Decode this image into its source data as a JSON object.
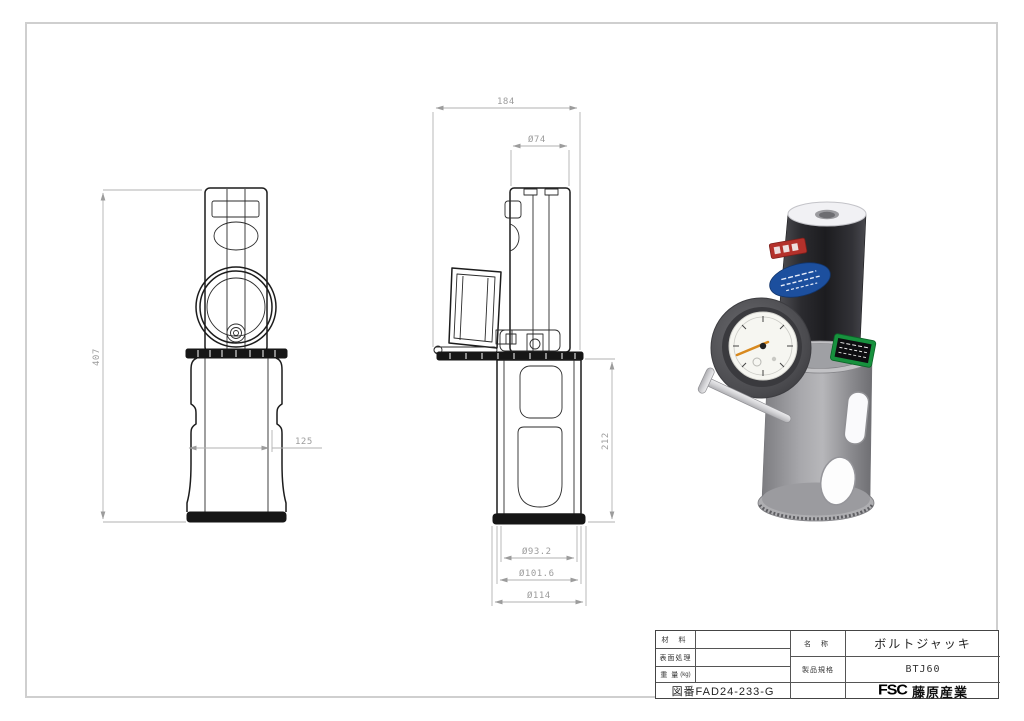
{
  "dimensions": {
    "front_height": "407",
    "front_base_width": "125",
    "side_overall_width": "184",
    "cylinder_diameter": "Ø74",
    "base_height": "212",
    "base_inner_diameter": "Ø93.2",
    "base_outer_diameter": "Ø101.6",
    "flange_diameter": "Ø114"
  },
  "title_block": {
    "material_label": "材 料",
    "surface_treatment_label": "表面処理",
    "weight_label": "重 量",
    "weight_unit": "(kg)",
    "drawing_number": "図番FAD24-233-G",
    "name_label": "名 称",
    "name_value": "ボルトジャッキ",
    "spec_label": "製品規格",
    "spec_value": "BTJ60",
    "brand_logo": "FSC",
    "brand_name": "藤原産業"
  },
  "colors": {
    "outline": "#1c1c1c",
    "dimension_gray": "#9c9c9c",
    "render_black_body": "#26262a",
    "render_gray_base": "#97979b",
    "label_red": "#b4312b",
    "label_blue": "#1c4f9e",
    "label_green": "#17923e",
    "gauge_needle_orange": "#d8891e"
  }
}
